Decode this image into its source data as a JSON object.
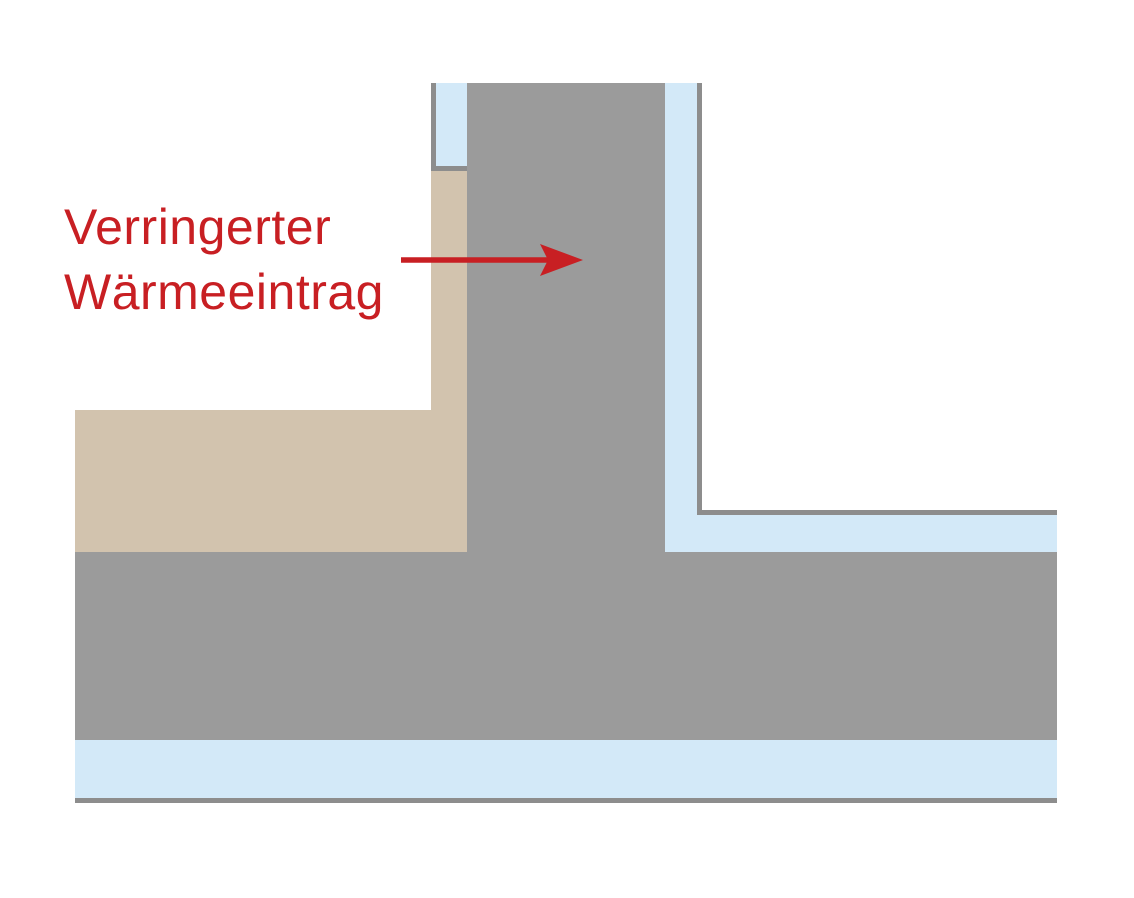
{
  "diagram": {
    "type": "construction-detail",
    "annotation": {
      "line1": "Verringerter",
      "line2": "Wärmeeintrag"
    }
  },
  "colors": {
    "background": "#ffffff",
    "annotation_red": "#c81f23",
    "concrete_gray": "#9b9b9b",
    "outline_gray": "#8d8d8d",
    "insulation_blue": "#d3e9f8",
    "soil_tan": "#d2c3ae"
  }
}
